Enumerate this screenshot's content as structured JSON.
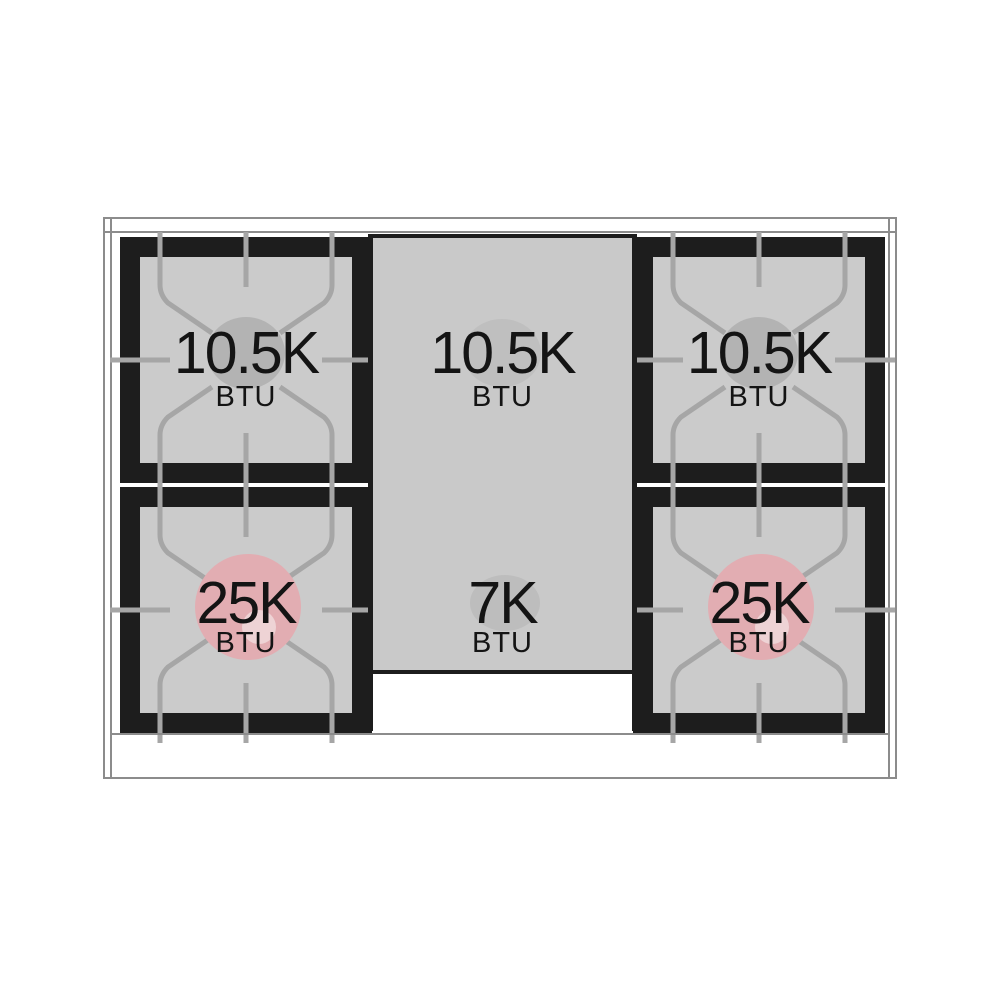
{
  "title": "Gas cooktop burner BTU layout diagram",
  "colors": {
    "top_burner_oval": "#b3b3b3",
    "center_top_oval": "#bfbfbf",
    "center_bottom_oval": "#bdbdbd",
    "power_burner_ring": "#e2adb2",
    "power_burner_ring_hole": "#eed3d5"
  },
  "burners": [
    {
      "position": "top-left",
      "value": "10.5K",
      "unit": "BTU"
    },
    {
      "position": "top-center",
      "value": "10.5K",
      "unit": "BTU"
    },
    {
      "position": "top-right",
      "value": "10.5K",
      "unit": "BTU"
    },
    {
      "position": "bottom-left",
      "value": "25K",
      "unit": "BTU"
    },
    {
      "position": "bottom-center",
      "value": "7K",
      "unit": "BTU"
    },
    {
      "position": "bottom-right",
      "value": "25K",
      "unit": "BTU"
    }
  ]
}
